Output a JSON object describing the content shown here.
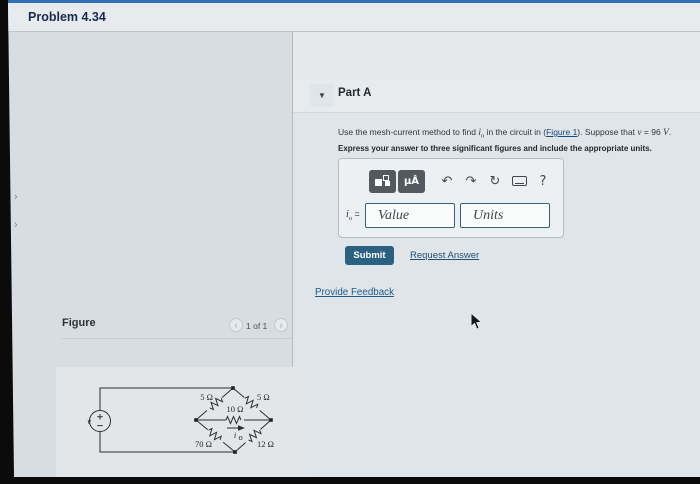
{
  "window": {
    "title": "Problem 4.34"
  },
  "left_rail": {
    "chevron_1": "›",
    "chevron_2": "›"
  },
  "part_a": {
    "header": "Part A",
    "collapse_glyph": "▼",
    "statement": {
      "text_1": "Use the mesh-current method to find ",
      "i_var": "i",
      "i_sub": "o",
      "text_2": " in the circuit in (",
      "figure_link": "Figure 1",
      "text_3": "). Suppose that ",
      "v_var": "v",
      "text_4": " = 96 ",
      "v_unit": "V",
      "text_5": ".",
      "instruction": "Express your answer to three significant figures and include the appropriate units."
    },
    "answer": {
      "toolbar": {
        "units_button_label": "μÅ",
        "undo_glyph": "↶",
        "redo_glyph": "↷",
        "reset_glyph": "↻",
        "help_glyph": "?"
      },
      "label_i": "i",
      "label_sub": "o",
      "equals": " =",
      "value_placeholder": "Value",
      "units_placeholder": "Units"
    },
    "submit_label": "Submit",
    "request_answer_label": "Request Answer",
    "provide_feedback_label": "Provide Feedback"
  },
  "figure_section": {
    "label": "Figure",
    "pagination": {
      "prev_glyph": "‹",
      "current": "1 of 1",
      "next_glyph": "›"
    }
  },
  "circuit": {
    "source_label": "v",
    "r_top_left": "5 Ω",
    "r_top_right": "5 Ω",
    "r_middle": "10 Ω",
    "r_bottom_left": "70 Ω",
    "r_bottom_right": "12 Ω",
    "current_i": "i",
    "current_sub": "o"
  },
  "colors": {
    "top_accent": "#336fb4",
    "submit_bg": "#2b6080",
    "link": "#1d5a8c",
    "toolbar_button_bg": "#54585f",
    "input_border": "#37627a",
    "page_bg": "#d8dde2"
  }
}
